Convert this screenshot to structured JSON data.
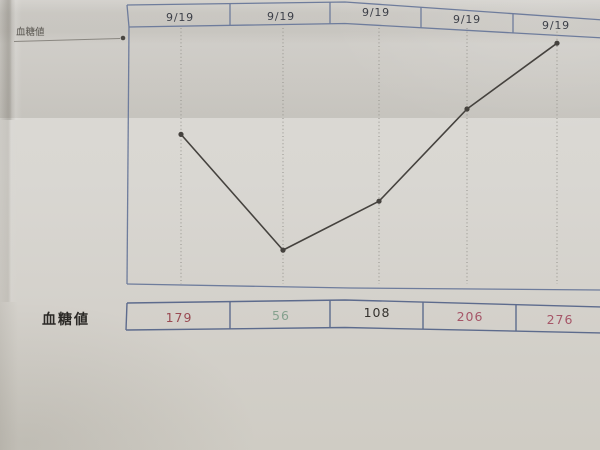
{
  "legend": {
    "label": "血糖値"
  },
  "value_row": {
    "label": "血糖値"
  },
  "chart_data": {
    "type": "line",
    "title": "血糖値",
    "series_name": "血糖値",
    "categories": [
      "9/19",
      "9/19",
      "9/19",
      "9/19",
      "9/19"
    ],
    "values": [
      179,
      56,
      108,
      206,
      276
    ],
    "value_colors": [
      "#9a4a52",
      "#85a18e",
      "#35322e",
      "#a65668",
      "#a65668"
    ],
    "xlabel": "",
    "ylabel": "",
    "ylim": [
      20,
      290
    ],
    "grid": "vertical-dotted",
    "legend_position": "top-left",
    "marker": "dot"
  },
  "colors": {
    "border_blue": "#6e7c9c",
    "line": "#45423e",
    "gridline": "#94928c",
    "date_text": "#3d4049",
    "label_text": "#2b2926",
    "paper": "#d8d6d1"
  }
}
